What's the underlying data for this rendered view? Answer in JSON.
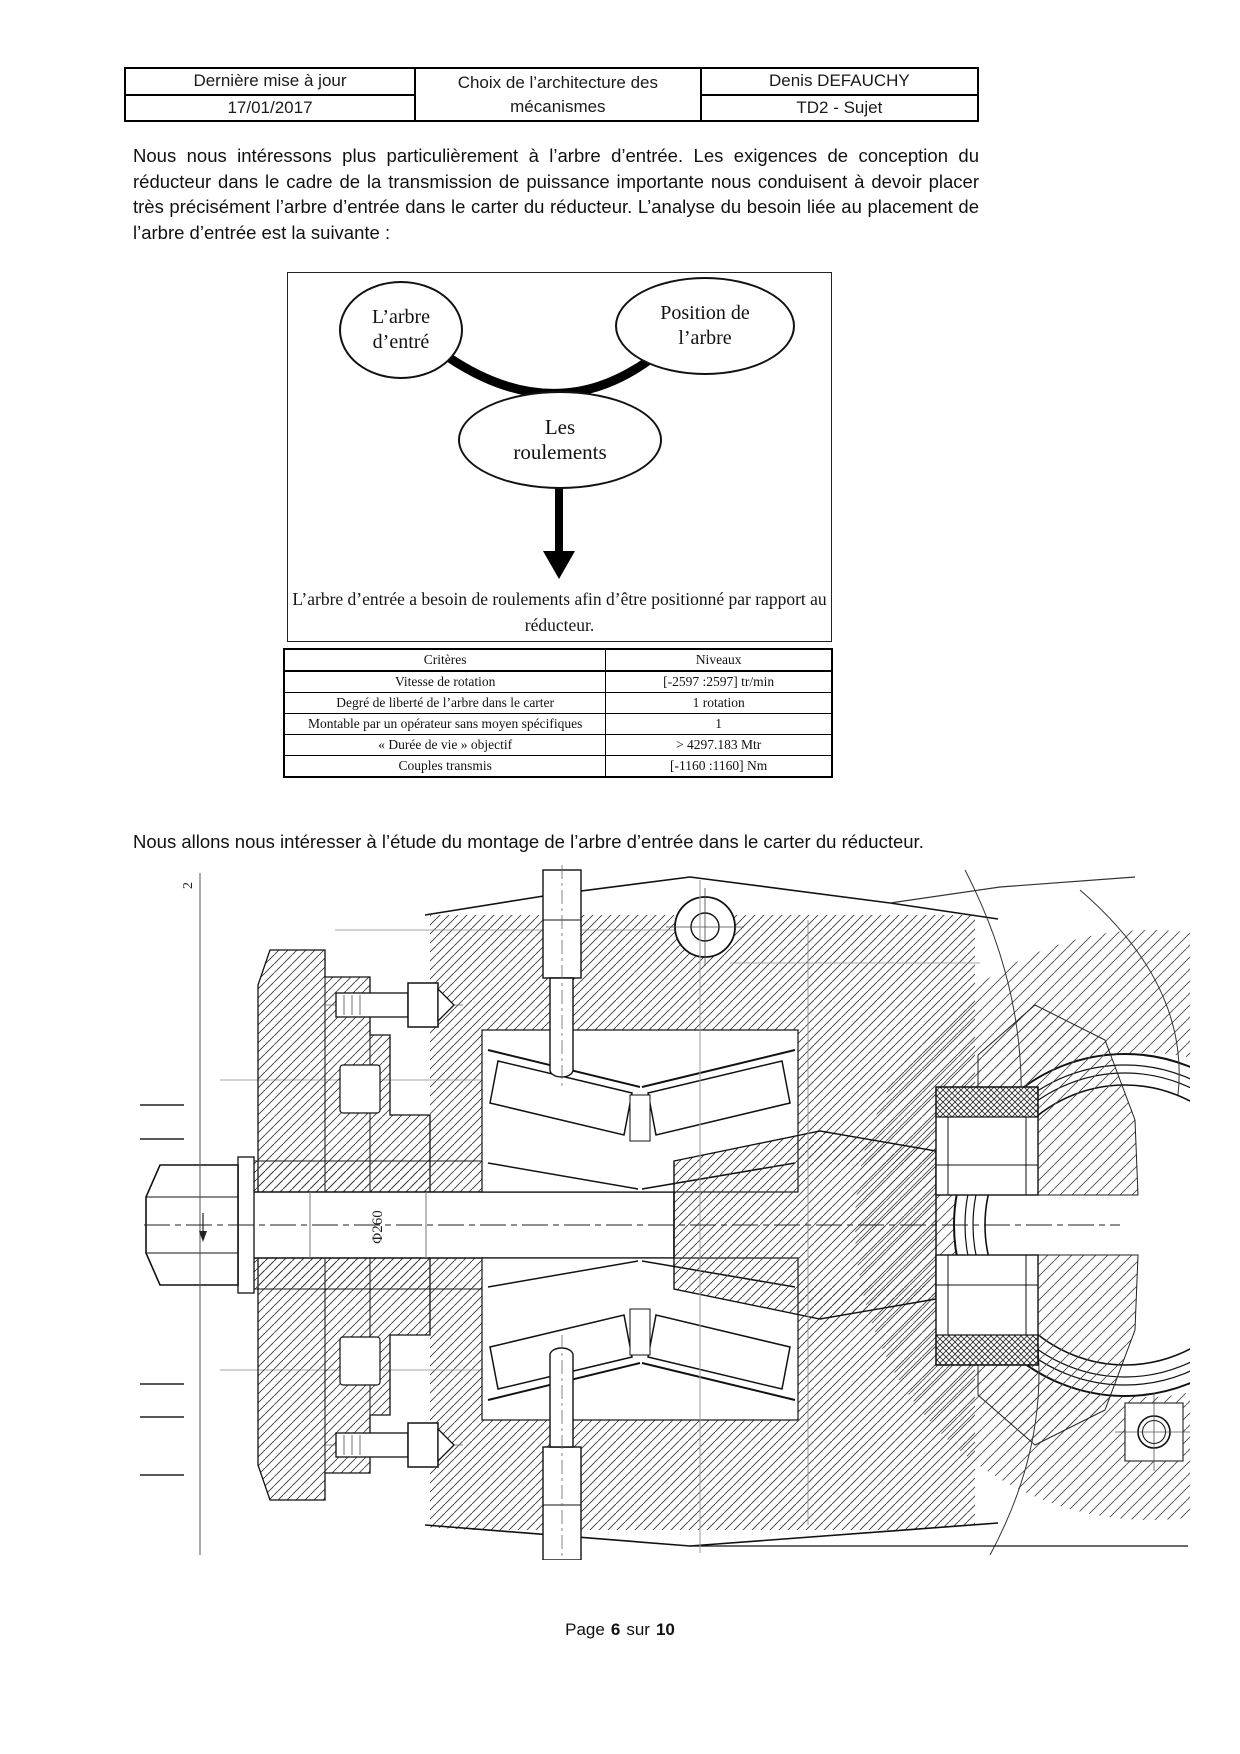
{
  "header_table": {
    "left": {
      "row1": "Dernière mise à jour",
      "row2": "17/01/2017"
    },
    "center": {
      "line1": "Choix de l’architecture des",
      "line2": "mécanismes"
    },
    "right": {
      "row1": "Denis DEFAUCHY",
      "row2": "TD2 - Sujet"
    }
  },
  "paragraphs": {
    "intro": "Nous nous intéressons plus particulièrement à l’arbre d’entrée. Les exigences de conception du réducteur dans le cadre de la transmission de puissance importante nous conduisent à devoir placer très précisément l’arbre d’entrée dans le carter du réducteur. L’analyse du besoin liée au placement de l’arbre d’entrée est la suivante :",
    "study": "Nous allons nous intéresser à l’étude du montage de l’arbre d’entrée dans le carter du réducteur."
  },
  "need_diagram": {
    "bubble_left": {
      "line1": "L’arbre",
      "line2": "d’entré"
    },
    "bubble_right": {
      "line1": "Position de",
      "line2": "l’arbre"
    },
    "bubble_center": {
      "line1": "Les",
      "line2": "roulements"
    },
    "conclusion": {
      "line1": "L’arbre d’entrée a besoin de roulements afin d’être positionné par rapport au",
      "line2": "réducteur."
    }
  },
  "criteria_table": {
    "headers": [
      "Critères",
      "Niveaux"
    ],
    "rows": [
      [
        "Vitesse de rotation",
        "[-2597 :2597] tr/min"
      ],
      [
        "Degré de liberté de l’arbre dans le carter",
        "1 rotation"
      ],
      [
        "Montable par un opérateur sans moyen spécifiques",
        "1"
      ],
      [
        "« Durée de vie » objectif",
        "> 4297.183 Mtr"
      ],
      [
        "Couples transmis",
        "[-1160 :1160] Nm"
      ]
    ]
  },
  "drawing": {
    "labels": {
      "diameter": "Φ260",
      "section_mark": "2"
    }
  },
  "footer": {
    "word_page": "Page",
    "num_current": "6",
    "word_sur": "sur",
    "num_total": "10"
  }
}
